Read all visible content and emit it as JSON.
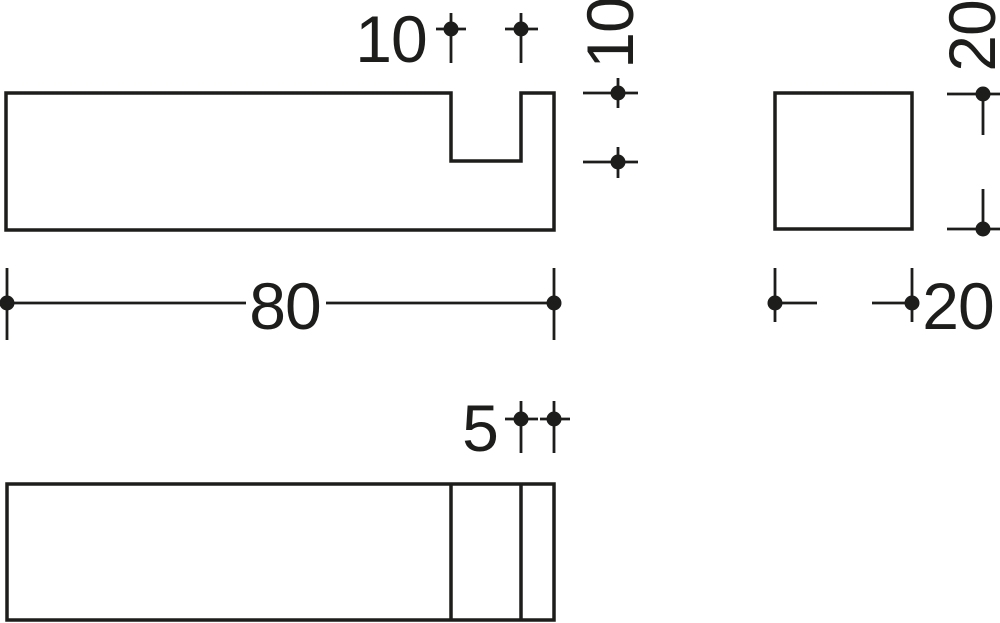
{
  "drawing": {
    "kind": "technical-dimension-drawing",
    "colors": {
      "line": "#1d1d1b",
      "background": "#ffffff"
    },
    "dimensions": {
      "notch_width": "10",
      "notch_depth": "10",
      "overall_length": "80",
      "end_height": "20",
      "end_width": "20",
      "wall_thickness": "5"
    }
  }
}
